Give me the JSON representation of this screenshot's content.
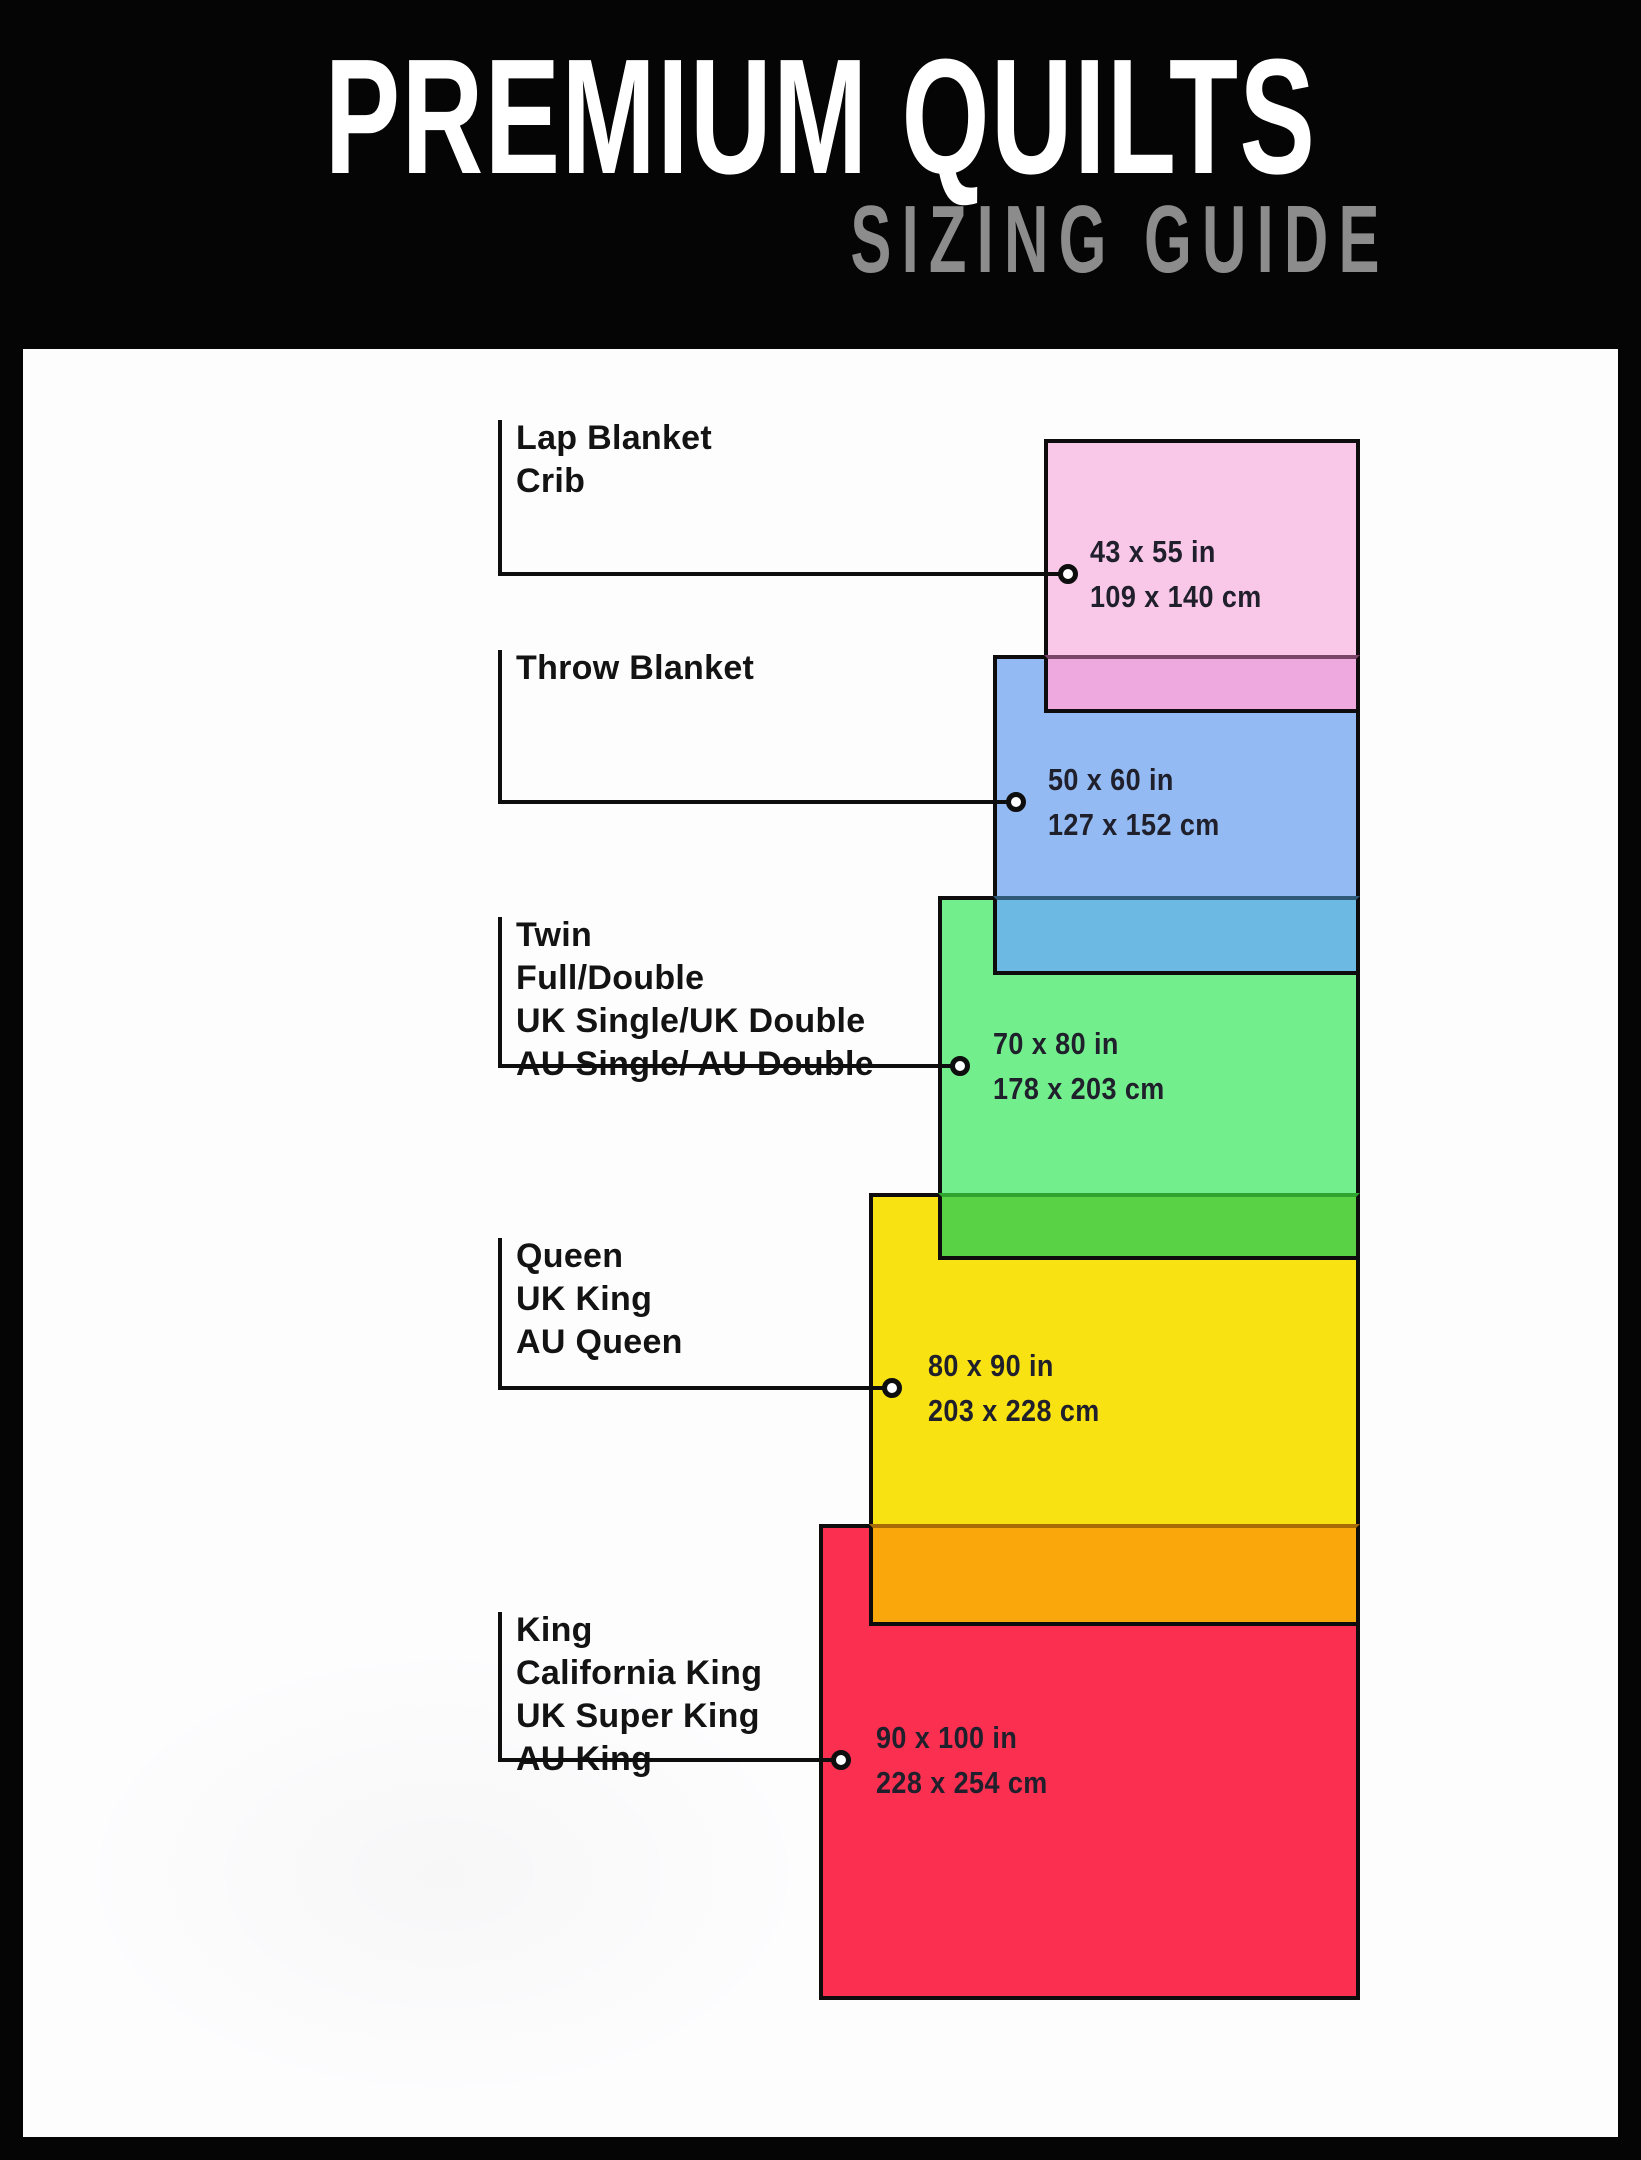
{
  "header": {
    "title": "PREMIUM QUILTS",
    "subtitle": "SIZING GUIDE"
  },
  "colors": {
    "background": "#060506",
    "panel": "#fdfdfe",
    "title_text": "#ffffff",
    "subtitle_text": "#8c8c8c",
    "label_text": "#131313",
    "dimension_text": "#20202c",
    "outline": "#0e0c0d"
  },
  "sizes": [
    {
      "names": [
        "Lap Blanket",
        "Crib"
      ],
      "inches": "43 x 55 in",
      "cm": "109 x 140 cm",
      "color": "#f9c8e8",
      "overlap_color": "#eeaade",
      "overlap_line": "#7a4468"
    },
    {
      "names": [
        "Throw Blanket"
      ],
      "inches": "50 x 60 in",
      "cm": "127 x 152 cm",
      "color": "#93baf2",
      "overlap_color": "#6cb9e3",
      "overlap_line": "#2e5a78"
    },
    {
      "names": [
        "Twin",
        "Full/Double",
        "UK Single/UK Double",
        "AU Single/ AU Double"
      ],
      "inches": "70 x 80 in",
      "cm": "178 x 203 cm",
      "color": "#73ee8c",
      "overlap_color": "#59d246",
      "overlap_line": "#2fa52f"
    },
    {
      "names": [
        "Queen",
        "UK King",
        "AU Queen"
      ],
      "inches": "80 x 90 in",
      "cm": "203 x 228 cm",
      "color": "#f9e211",
      "overlap_color": "#f9a70a",
      "overlap_line": "#a86b06"
    },
    {
      "names": [
        "King",
        "California King",
        "UK Super King",
        "AU King"
      ],
      "inches": "90 x 100 in",
      "cm": "228 x 254 cm",
      "color": "#fb3051",
      "overlap_color": null,
      "overlap_line": null
    }
  ]
}
